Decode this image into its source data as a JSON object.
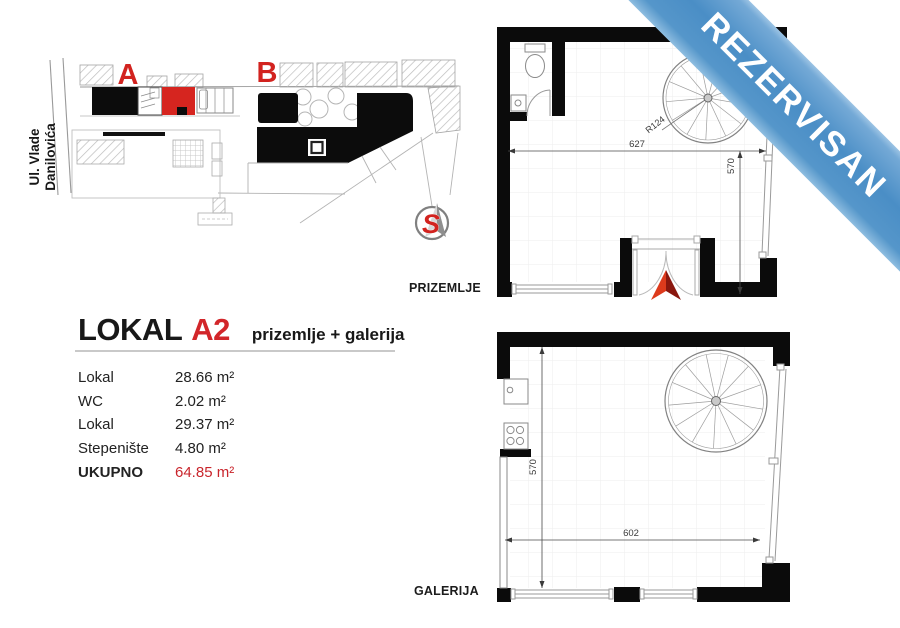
{
  "colors": {
    "accent_red": "#d2262a",
    "ribbon_blue": "#4a8ec6",
    "wall_black": "#0b0b0b"
  },
  "ribbon": {
    "text": "REZERVISAN"
  },
  "site_plan": {
    "street_line1": "Ul. Vlade",
    "street_line2": "Danilovića",
    "building_a_label": "A",
    "building_b_label": "B",
    "compass_label": "S"
  },
  "unit": {
    "title_prefix": "LOKAL",
    "title_code": "A2",
    "subtitle": "prizemlje + galerija",
    "areas": [
      {
        "label": "Lokal",
        "value": "28.66 m²"
      },
      {
        "label": "WC",
        "value": "2.02 m²"
      },
      {
        "label": "Lokal",
        "value": "29.37 m²"
      },
      {
        "label": "Stepenište",
        "value": "4.80 m²"
      }
    ],
    "total_label": "UKUPNO",
    "total_value": "64.85 m²"
  },
  "plans": {
    "prizemlje": {
      "label": "PRIZEMLJE",
      "dims": {
        "width": "627",
        "height": "570",
        "stair_radius": "R124"
      }
    },
    "galerija": {
      "label": "GALERIJA",
      "dims": {
        "width": "602",
        "height": "570"
      }
    }
  }
}
